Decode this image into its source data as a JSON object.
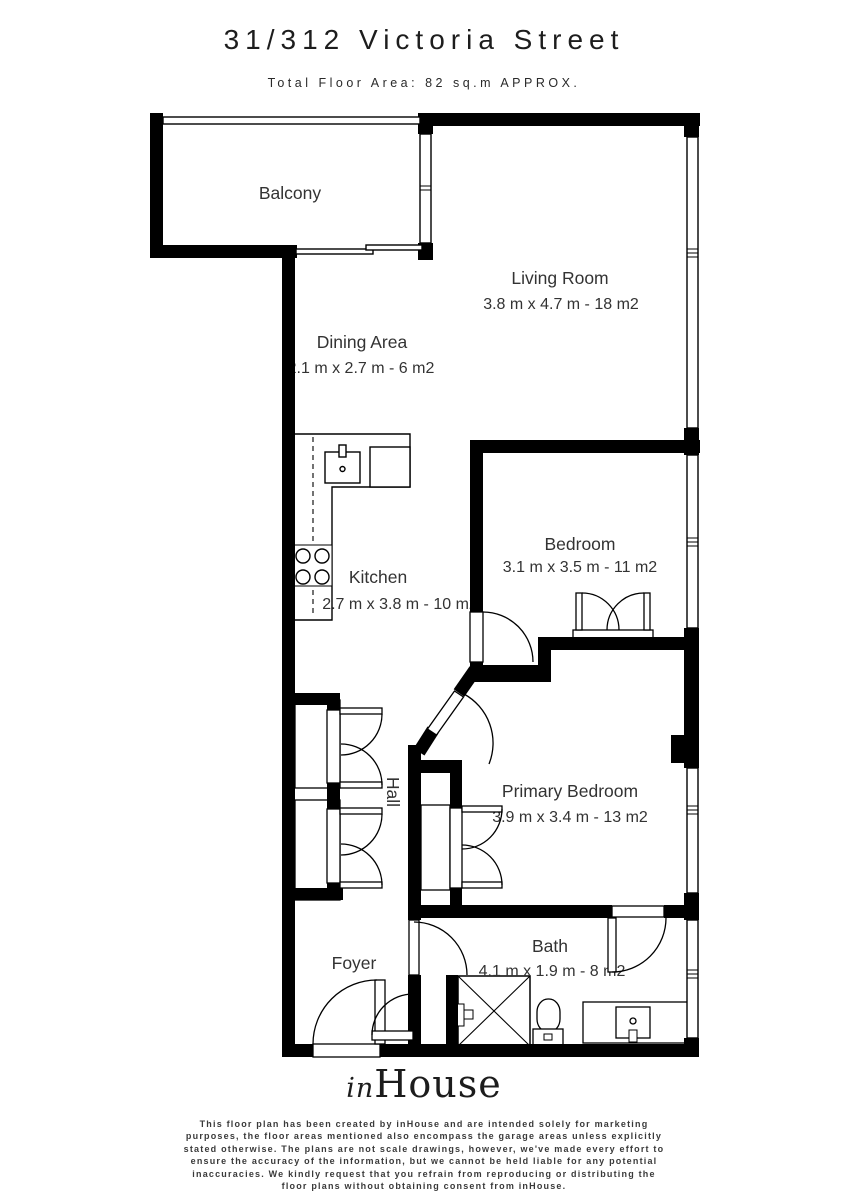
{
  "header": {
    "title": "31/312 Victoria Street",
    "subtitle": "Total Floor Area: 82 sq.m APPROX."
  },
  "rooms": {
    "balcony": {
      "name": "Balcony"
    },
    "living": {
      "name": "Living Room",
      "dims": "3.8 m x 4.7 m - 18 m2"
    },
    "dining": {
      "name": "Dining Area",
      "dims": "2.1 m x 2.7 m - 6 m2"
    },
    "kitchen": {
      "name": "Kitchen",
      "dims": "2.7 m x 3.8 m - 10 m2"
    },
    "bedroom": {
      "name": "Bedroom",
      "dims": "3.1 m x 3.5 m - 11 m2"
    },
    "primary": {
      "name": "Primary Bedroom",
      "dims": "3.9 m x 3.4 m - 13 m2"
    },
    "hall": {
      "name": "Hall"
    },
    "foyer": {
      "name": "Foyer"
    },
    "bath": {
      "name": "Bath",
      "dims": "4.1 m x 1.9 m - 8 m2"
    }
  },
  "footer": {
    "logo_in": "in",
    "logo_house": "House",
    "disclaimer_lines": [
      "This floor plan has been created by inHouse and are intended solely for marketing",
      "purposes, the floor areas mentioned also encompass the garage areas unless explicitly",
      "stated otherwise. The plans are not scale drawings, however, we've made every effort to",
      "ensure the accuracy of the information, but we cannot be held liable for any potential",
      "inaccuracies. We kindly request that you refrain from reproducing or distributing the",
      "floor plans without obtaining consent from inHouse."
    ]
  },
  "colors": {
    "wall": "#000000",
    "label": "#333333",
    "background": "#ffffff"
  }
}
